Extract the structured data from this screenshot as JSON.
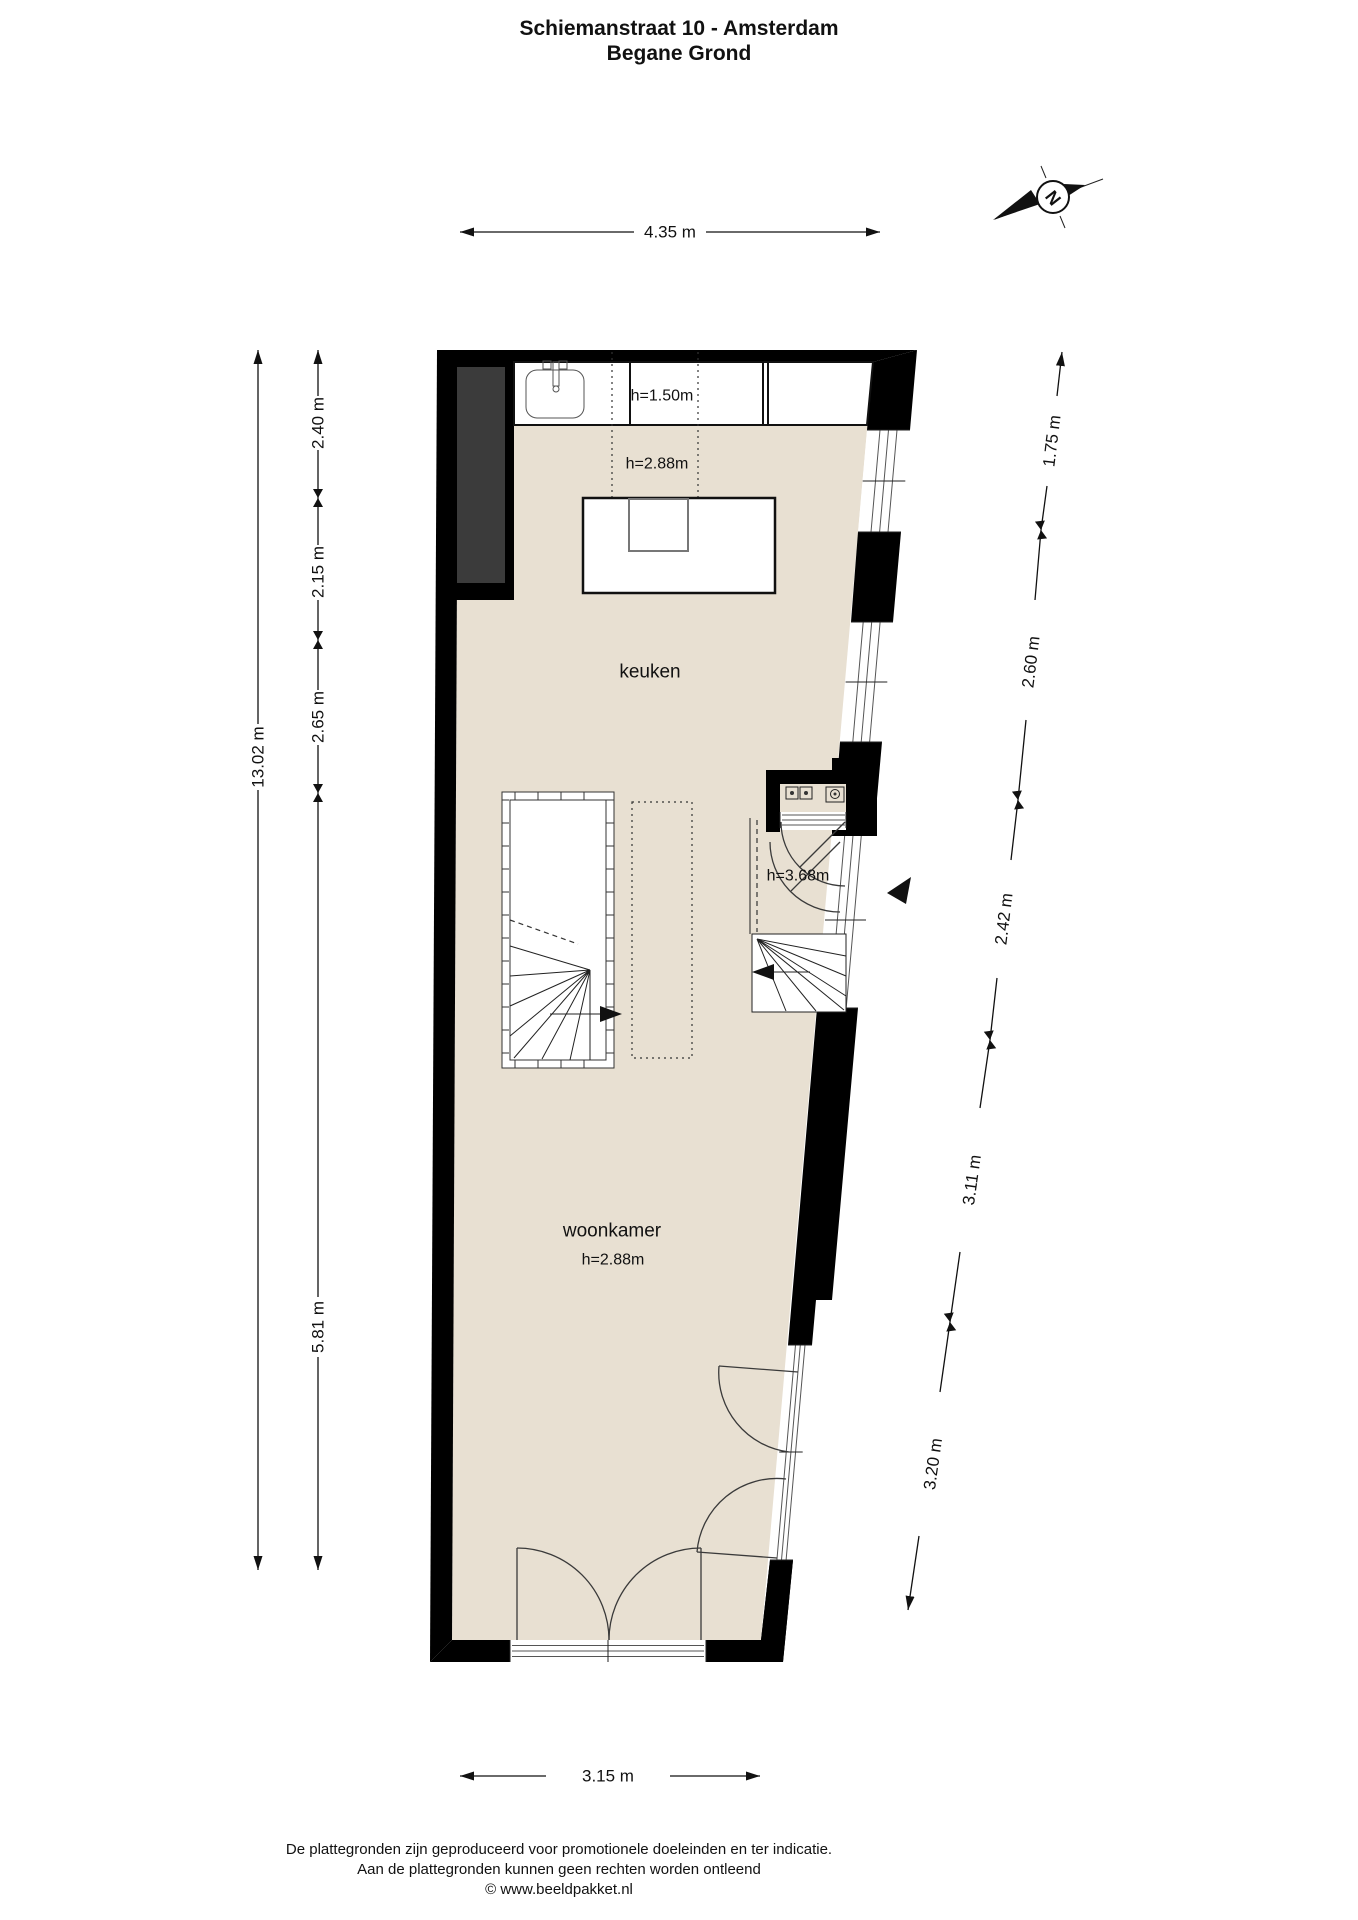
{
  "title": {
    "address": "Schiemanstraat 10 - Amsterdam",
    "floor": "Begane Grond"
  },
  "labels": {
    "kitchen": "keuken",
    "living": "woonkamer",
    "h_counter": "h=1.50m",
    "h_kitchen": "h=2.88m",
    "h_living": "h=2.88m",
    "h_hall": "h=3.68m"
  },
  "dimensions": {
    "top": "4.35 m",
    "bottom": "3.15 m",
    "left_total": "13.02 m",
    "left": [
      "2.40 m",
      "2.15 m",
      "2.65 m",
      "5.81 m"
    ],
    "right": [
      "1.75 m",
      "2.60 m",
      "2.42 m",
      "3.11 m",
      "3.20 m"
    ]
  },
  "compass": {
    "north_letter": "N"
  },
  "footer": {
    "line1": "De plattegronden zijn geproduceerd voor promotionele doeleinden en ter indicatie.",
    "line2": "Aan de plattegronden kunnen geen rechten worden ontleend",
    "line3": "© www.beeldpakket.nl"
  },
  "colors": {
    "floor": "#e8e0d2",
    "wall": "#000000",
    "closet": "#3b3b3b",
    "line": "#222222"
  }
}
